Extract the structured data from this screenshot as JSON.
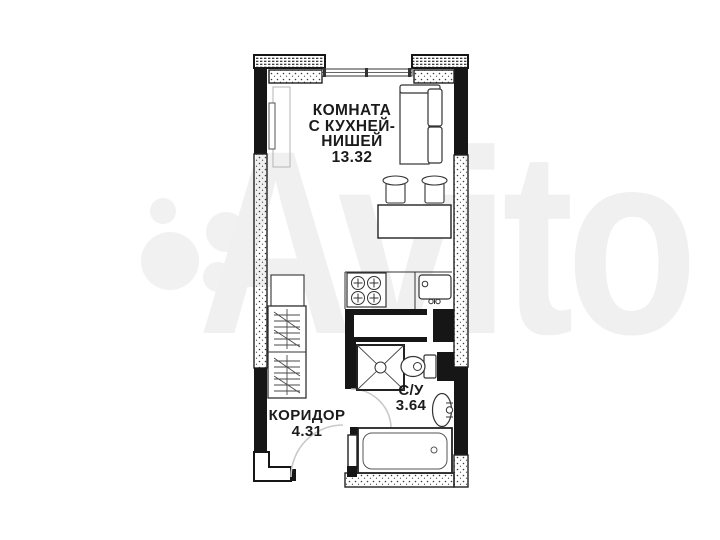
{
  "watermark": {
    "brand": "Avito"
  },
  "plan": {
    "rooms": {
      "living": {
        "name_lines": [
          "КОМНАТА",
          "С КУХНЕЙ-",
          "НИШЕЙ"
        ],
        "area": "13.32"
      },
      "corridor": {
        "name": "КОРИДОР",
        "area": "4.31"
      },
      "bathroom": {
        "name": "С/У",
        "area": "3.64"
      }
    },
    "fixtures": [
      "window",
      "radiator",
      "sofa",
      "bar-stool",
      "bar-stool",
      "table",
      "refrigerator",
      "wardrobe",
      "stove",
      "kitchen-sink",
      "duct-shaft",
      "shower",
      "toilet",
      "washbasin",
      "bathtub",
      "entrance-door",
      "bathroom-door"
    ]
  },
  "colors": {
    "wall": "#161616",
    "furniture_line": "#333333",
    "door_arc": "#c9c9c9",
    "text": "#1b1b1b",
    "watermark": "#f0f0f0",
    "background": "#ffffff"
  }
}
